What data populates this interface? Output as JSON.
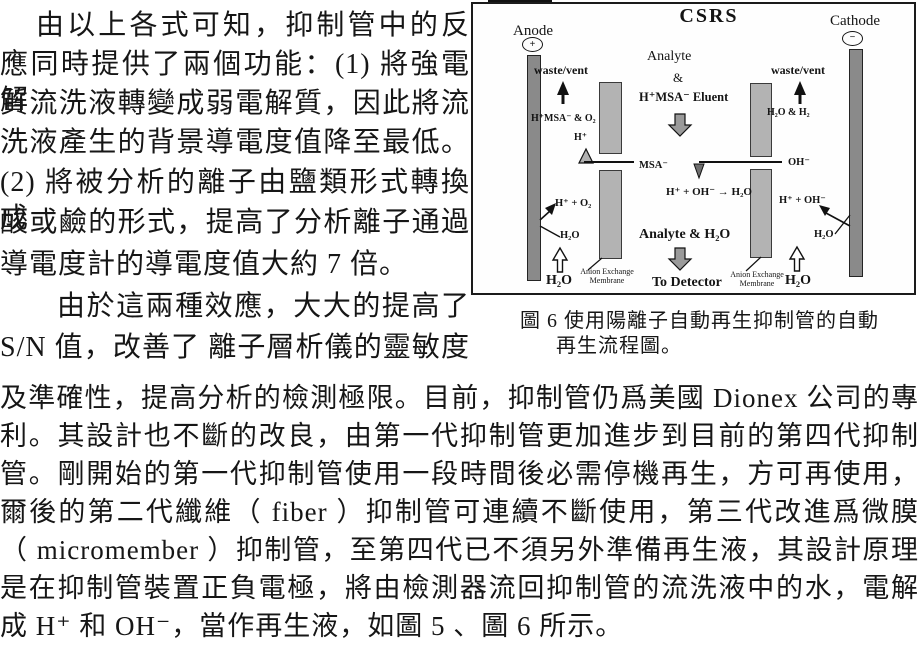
{
  "body": {
    "lines": [
      "由以上各式可知，抑制管中的反",
      "應同時提供了兩個功能：(1) 將強電解",
      "質流洗液轉變成弱電解質，因此將流",
      "洗液產生的背景導電度值降至最低。",
      "(2) 將被分析的離子由鹽類形式轉換成",
      "酸或鹼的形式，提高了分析離子通過",
      "導電度計的導電度值大約 7 倍。",
      "由於這兩種效應，大大的提高了",
      "S/N 值，改善了 離子層析儀的靈敏度",
      "及準確性，提高分析的檢測極限。目前，抑制管仍爲美國 Dionex 公司的專",
      "利。其設計也不斷的改良，由第一代抑制管更加進步到目前的第四代抑制",
      "管。剛開始的第一代抑制管使用一段時間後必需停機再生，方可再使用，",
      "爾後的第二代纖維（ fiber ）抑制管可連續不斷使用，第三代改進爲微膜",
      "（ micromember ）抑制管，至第四代已不須另外準備再生液，其設計原理",
      "是在抑制管裝置正負電極，將由檢測器流回抑制管的流洗液中的水，電解",
      "成 H⁺ 和 OH⁻，當作再生液，如圖 5 、圖 6 所示。"
    ]
  },
  "figure": {
    "title": "CSRS",
    "anode": {
      "label": "Anode",
      "symbol": "+"
    },
    "cathode": {
      "label": "Cathode",
      "symbol": "−"
    },
    "left": {
      "waste_vent": "waste/vent",
      "out_species": "H⁺MSA⁻ & O₂",
      "h_ion": "H⁺",
      "msa_ion": "MSA⁻",
      "electrode_reaction": "H⁺ + O₂",
      "water_mid": "H₂O",
      "water_in": "H₂O",
      "membrane_label_1": "Anion Exchange",
      "membrane_label_2": "Membrane"
    },
    "center": {
      "analyte": "Analyte",
      "ampersand": "&",
      "eluent": "H⁺MSA⁻ Eluent",
      "neutralization": "H⁺ + OH⁻ → H₂O",
      "analyte_out": "Analyte & H₂O",
      "to_detector": "To Detector"
    },
    "right": {
      "waste_vent": "waste/vent",
      "out_species": "H₂O & H₂",
      "oh_ion": "OH⁻",
      "electrode_reaction": "H⁺ + OH⁻",
      "water_mid": "H₂O",
      "water_in": "H₂O",
      "membrane_label_1": "Anion Exchange",
      "membrane_label_2": "Membrane"
    },
    "caption": {
      "line1": "圖 6 使用陽離子自動再生抑制管的自動",
      "line2": "再生流程圖。"
    }
  },
  "colors": {
    "ink": "#1a1a1a",
    "electrode_gray": "#8a8a8a",
    "membrane_gray": "#b3b3b3",
    "block_arrow_gray": "#9a9a9a"
  }
}
